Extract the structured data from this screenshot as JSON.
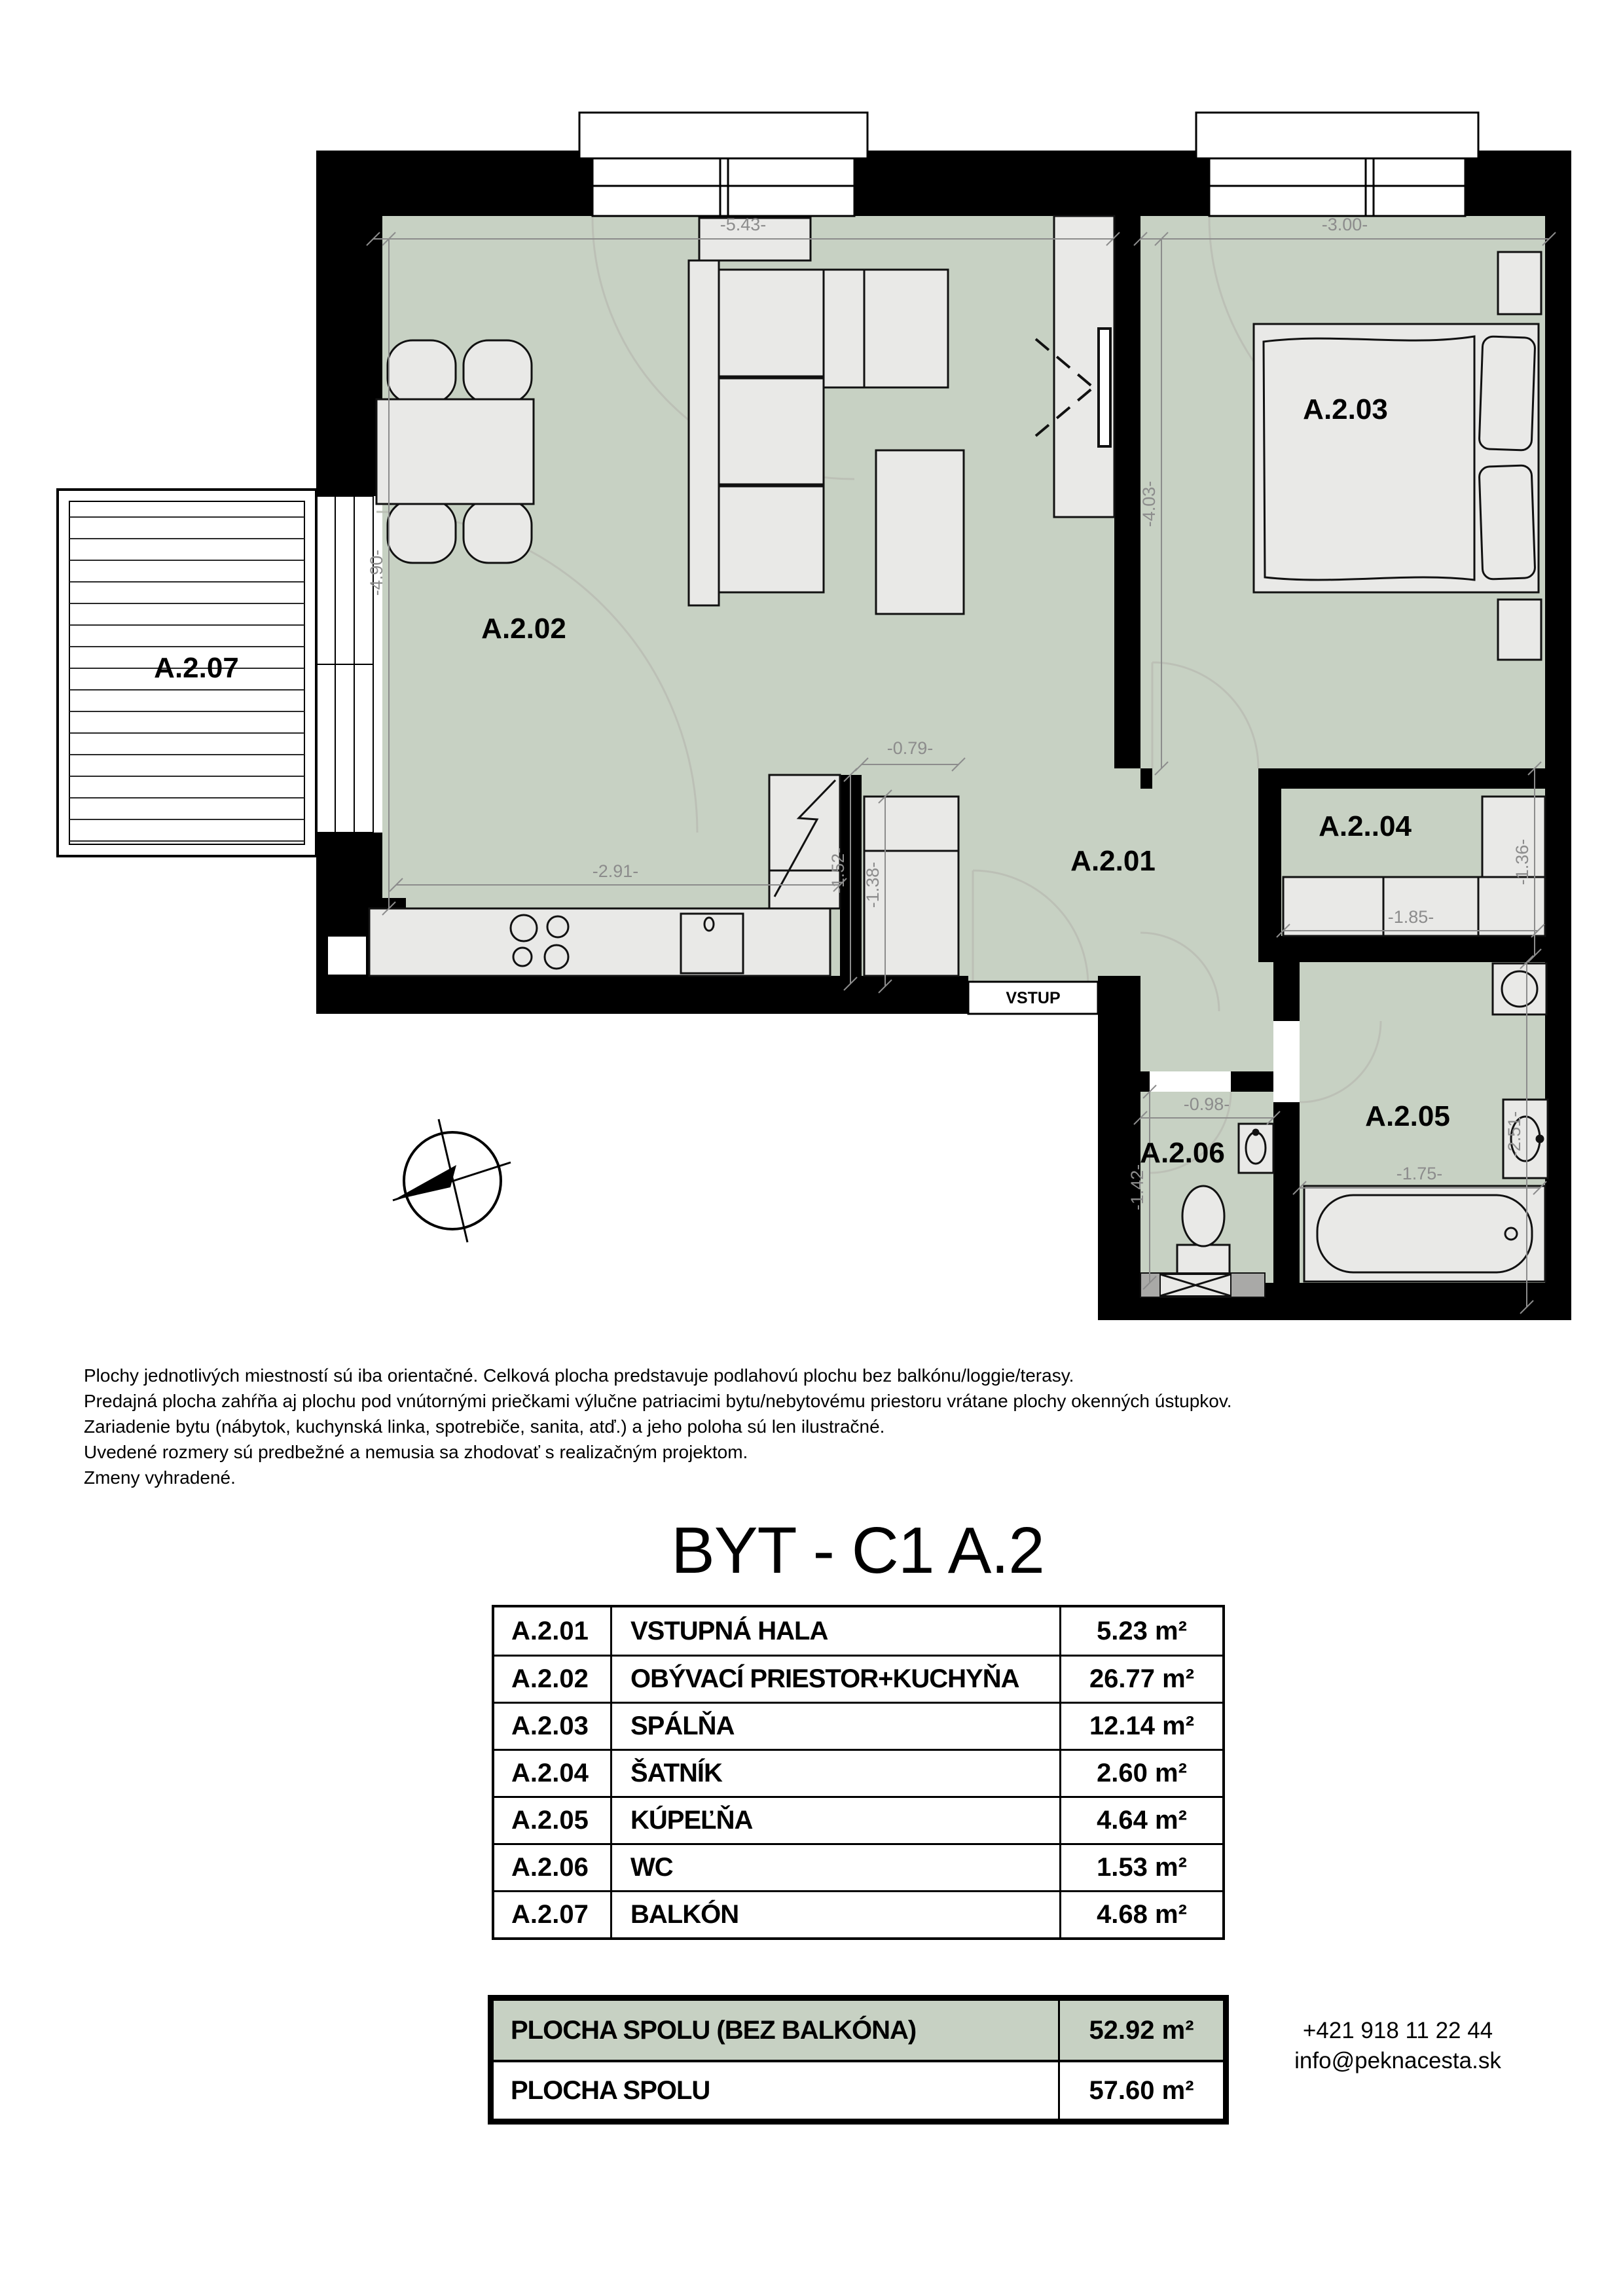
{
  "plan": {
    "labels": {
      "living": "A.2.02",
      "bedroom": "A.2.03",
      "hall": "A.2.01",
      "closet": "A.2..04",
      "bathroom": "A.2.05",
      "wc": "A.2.06",
      "balcony": "A.2.07",
      "entrance": "VSTUP"
    },
    "dims": {
      "living_width": "-5.43-",
      "bedroom_width": "-3.00-",
      "living_height": "-4.90-",
      "bedroom_height": "-4.03-",
      "kitchen_width": "-2.91-",
      "kitchen_niche": "-0.79-",
      "kitchen_h1": "-1.52-",
      "kitchen_h2": "-1.38-",
      "closet_width": "-1.85-",
      "closet_height": "-1.36-",
      "wc_width": "-0.98-",
      "wc_height": "-1.42-",
      "bath_width": "-1.75-",
      "bath_height": "-2.51-"
    },
    "colors": {
      "floor": "#c7d1c3",
      "furniture": "#e9e9e7",
      "wall": "#000000",
      "dimension": "#8c8c8c"
    }
  },
  "notes": {
    "lines": [
      "Plochy jednotlivých miestností sú iba orientačné. Celková plocha predstavuje podlahovú plochu bez balkónu/loggie/terasy.",
      "Predajná plocha zahŕňa aj plochu pod vnútornými priečkami výlučne patriacimi bytu/nebytovému priestoru vrátane plochy okenných ústupkov.",
      "Zariadenie bytu (nábytok, kuchynská linka, spotrebiče, sanita, atď.) a jeho poloha sú len ilustračné.",
      "Uvedené rozmery sú predbežné a nemusia sa zhodovať s realizačným projektom.",
      "Zmeny vyhradené."
    ]
  },
  "title": "BYT - C1 A.2",
  "table": {
    "rows": [
      {
        "code": "A.2.01",
        "name": "VSTUPNÁ HALA",
        "area": "5.23 m²"
      },
      {
        "code": "A.2.02",
        "name": "OBÝVACÍ PRIESTOR+KUCHYŇA",
        "area": "26.77 m²"
      },
      {
        "code": "A.2.03",
        "name": "SPÁLŇA",
        "area": "12.14 m²"
      },
      {
        "code": "A.2.04",
        "name": "ŠATNÍK",
        "area": "2.60 m²"
      },
      {
        "code": "A.2.05",
        "name": "KÚPEĽŇA",
        "area": "4.64 m²"
      },
      {
        "code": "A.2.06",
        "name": "WC",
        "area": "1.53 m²"
      },
      {
        "code": "A.2.07",
        "name": "BALKÓN",
        "area": "4.68 m²"
      }
    ],
    "totals": [
      {
        "name": "PLOCHA SPOLU (BEZ BALKÓNA)",
        "area": "52.92 m²"
      },
      {
        "name": "PLOCHA SPOLU",
        "area": "57.60 m²"
      }
    ]
  },
  "contact": {
    "phone": "+421 918 11 22 44",
    "email": "info@peknacesta.sk"
  }
}
